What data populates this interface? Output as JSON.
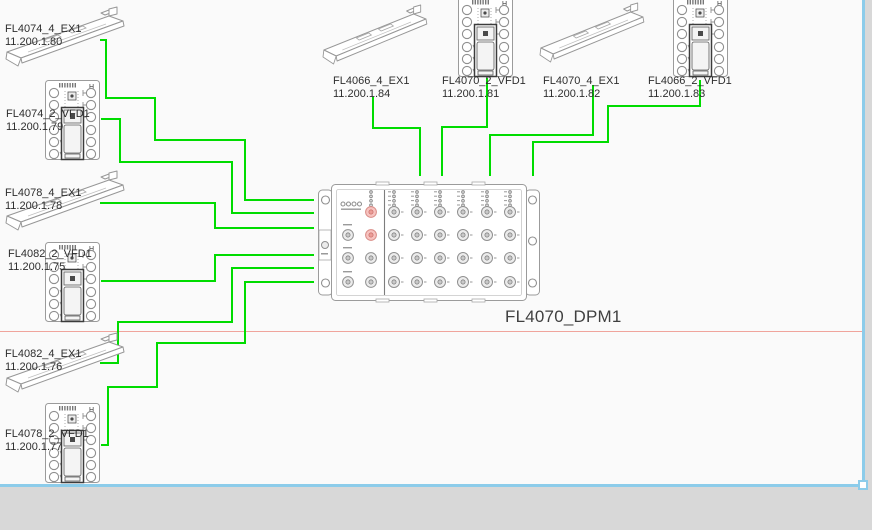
{
  "colors": {
    "wire": "#00dc00",
    "page_line": "#f0a49c",
    "selection": "#8cccea",
    "canvas": "#fafafa",
    "workspace": "#d8d8d8"
  },
  "hub": {
    "name": "FL4070_DPM1",
    "x": 318,
    "y": 183,
    "label": {
      "x": 505,
      "y": 307
    }
  },
  "devices": [
    {
      "name": "FL4074_4_EX1",
      "ip": "11.200.1.80",
      "type": "rail",
      "x": 6,
      "y": 10,
      "label": {
        "x": 5,
        "y": 23
      }
    },
    {
      "name": "FL4074_2_VFD1",
      "ip": "11.200.1.79",
      "type": "vfd",
      "x": 45,
      "y": 80,
      "label": {
        "x": 6,
        "y": 108
      }
    },
    {
      "name": "FL4078_4_EX1",
      "ip": "11.200.1.78",
      "type": "rail",
      "x": 6,
      "y": 174,
      "label": {
        "x": 5,
        "y": 187
      }
    },
    {
      "name": "FL4082_2_VFD1",
      "ip": "11.200.1.75",
      "type": "vfd",
      "x": 45,
      "y": 242,
      "label": {
        "x": 8,
        "y": 248
      }
    },
    {
      "name": "FL4082_4_EX1",
      "ip": "11.200.1.76",
      "type": "rail",
      "x": 6,
      "y": 336,
      "label": {
        "x": 5,
        "y": 348
      }
    },
    {
      "name": "FL4078_2_VFD1",
      "ip": "11.200.1.77",
      "type": "vfd",
      "x": 45,
      "y": 403,
      "label": {
        "x": 5,
        "y": 428
      }
    },
    {
      "name": "FL4066_4_EX1",
      "ip": "11.200.1.84",
      "type": "rail",
      "x": 323,
      "y": 8,
      "scale": 0.88,
      "label": {
        "x": 333,
        "y": 75
      }
    },
    {
      "name": "FL4070_2_VFD1",
      "ip": "11.200.1.81",
      "type": "vfd",
      "x": 458,
      "y": -3,
      "label": {
        "x": 442,
        "y": 75
      }
    },
    {
      "name": "FL4070_4_EX1",
      "ip": "11.200.1.82",
      "type": "rail",
      "x": 540,
      "y": 6,
      "scale": 0.88,
      "label": {
        "x": 543,
        "y": 75
      }
    },
    {
      "name": "FL4066_2_VFD1",
      "ip": "11.200.1.83",
      "type": "vfd",
      "x": 673,
      "y": -3,
      "label": {
        "x": 648,
        "y": 75
      }
    }
  ],
  "connections": [
    {
      "from": "FL4074_4_EX1",
      "to": "FL4070_DPM1",
      "points": [
        [
          100,
          40
        ],
        [
          106,
          40
        ],
        [
          106,
          98
        ],
        [
          155,
          98
        ],
        [
          155,
          140
        ],
        [
          245,
          140
        ],
        [
          245,
          200
        ],
        [
          314,
          200
        ]
      ]
    },
    {
      "from": "FL4074_2_VFD1",
      "to": "FL4070_DPM1",
      "points": [
        [
          101,
          119
        ],
        [
          120,
          119
        ],
        [
          120,
          162
        ],
        [
          232,
          162
        ],
        [
          232,
          213
        ],
        [
          314,
          213
        ]
      ]
    },
    {
      "from": "FL4078_4_EX1",
      "to": "FL4070_DPM1",
      "points": [
        [
          100,
          203
        ],
        [
          215,
          203
        ],
        [
          215,
          228
        ],
        [
          314,
          228
        ]
      ]
    },
    {
      "from": "FL4082_2_VFD1",
      "to": "FL4070_DPM1",
      "points": [
        [
          101,
          281
        ],
        [
          215,
          281
        ],
        [
          215,
          255
        ],
        [
          314,
          255
        ]
      ]
    },
    {
      "from": "FL4082_4_EX1",
      "to": "FL4070_DPM1",
      "points": [
        [
          100,
          363
        ],
        [
          118,
          363
        ],
        [
          118,
          322
        ],
        [
          232,
          322
        ],
        [
          232,
          268
        ],
        [
          314,
          268
        ]
      ]
    },
    {
      "from": "FL4078_2_VFD1",
      "to": "FL4070_DPM1",
      "points": [
        [
          101,
          445
        ],
        [
          108,
          445
        ],
        [
          108,
          387
        ],
        [
          157,
          387
        ],
        [
          157,
          343
        ],
        [
          245,
          343
        ],
        [
          245,
          282
        ],
        [
          314,
          282
        ]
      ]
    },
    {
      "from": "FL4066_4_EX1",
      "to": "FL4070_DPM1",
      "points": [
        [
          373,
          97
        ],
        [
          373,
          128
        ],
        [
          420,
          128
        ],
        [
          420,
          176
        ]
      ]
    },
    {
      "from": "FL4070_2_VFD1",
      "to": "FL4070_DPM1",
      "points": [
        [
          487,
          78
        ],
        [
          487,
          127
        ],
        [
          442,
          127
        ],
        [
          442,
          176
        ]
      ]
    },
    {
      "from": "FL4070_4_EX1",
      "to": "FL4070_DPM1",
      "points": [
        [
          593,
          85
        ],
        [
          593,
          135
        ],
        [
          490,
          135
        ],
        [
          490,
          176
        ]
      ]
    },
    {
      "from": "FL4066_2_VFD1",
      "to": "FL4070_DPM1",
      "points": [
        [
          700,
          80
        ],
        [
          700,
          106
        ],
        [
          608,
          106
        ],
        [
          608,
          142
        ],
        [
          533,
          142
        ],
        [
          533,
          176
        ]
      ]
    }
  ]
}
